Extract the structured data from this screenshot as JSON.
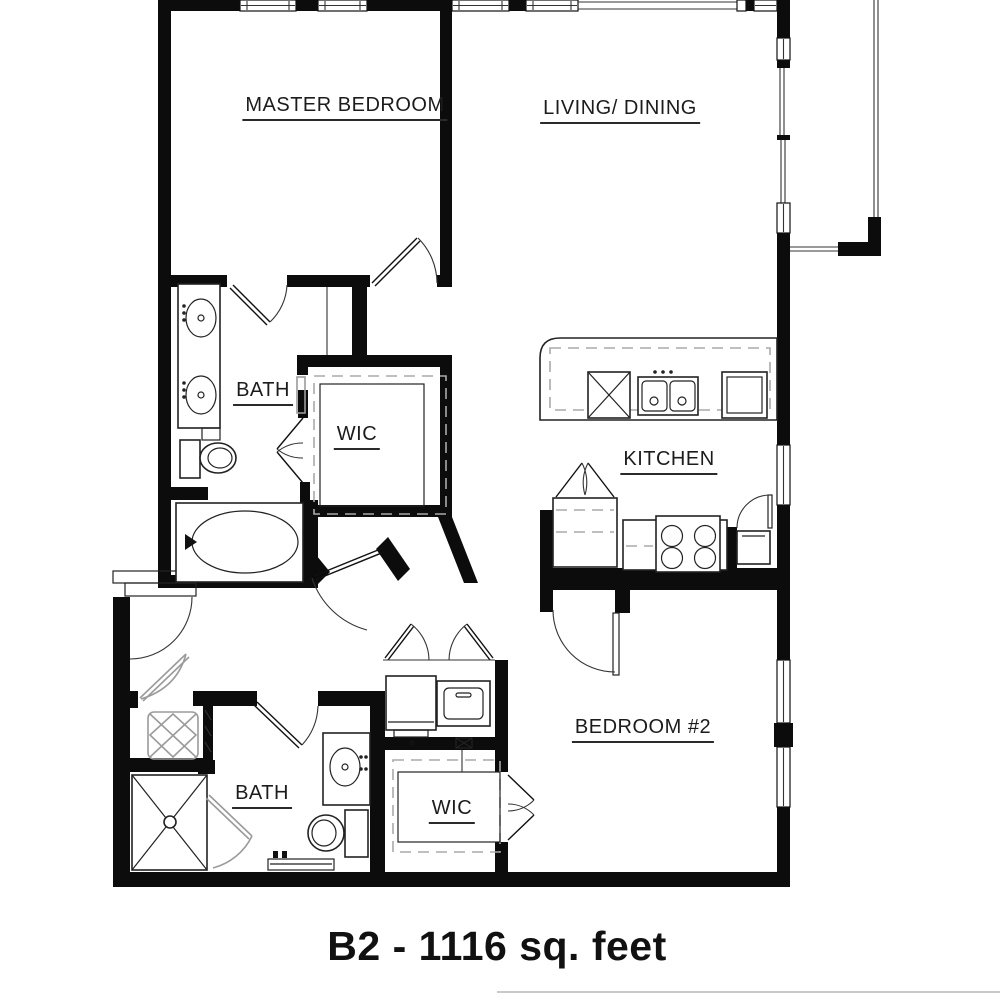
{
  "plan": {
    "title": "B2 - 1116 sq. feet",
    "rooms": {
      "master_bedroom": "MASTER BEDROOM",
      "living_dining": "LIVING/ DINING",
      "master_bath": "BATH",
      "master_wic": "WIC",
      "kitchen": "KITCHEN",
      "bath2": "BATH",
      "wic2": "WIC",
      "bedroom2": "BEDROOM #2"
    },
    "fixtures": [
      "double-vanity-sinks",
      "toilet",
      "bathtub",
      "walk-in-closet-shelving",
      "entry-stoop",
      "kitchen-counter",
      "dishwasher",
      "double-sink",
      "refrigerator",
      "pantry",
      "range-stove",
      "utility-closet",
      "water-heater",
      "washer",
      "linen-closet",
      "shower",
      "vanity-sink",
      "toilet-2",
      "wardrobe-shelving",
      "balcony"
    ],
    "colors": {
      "wall": "#0c0c0c",
      "background": "#ffffff",
      "light_fixture": "#9b9b9b",
      "text": "#1c1c1c"
    }
  }
}
